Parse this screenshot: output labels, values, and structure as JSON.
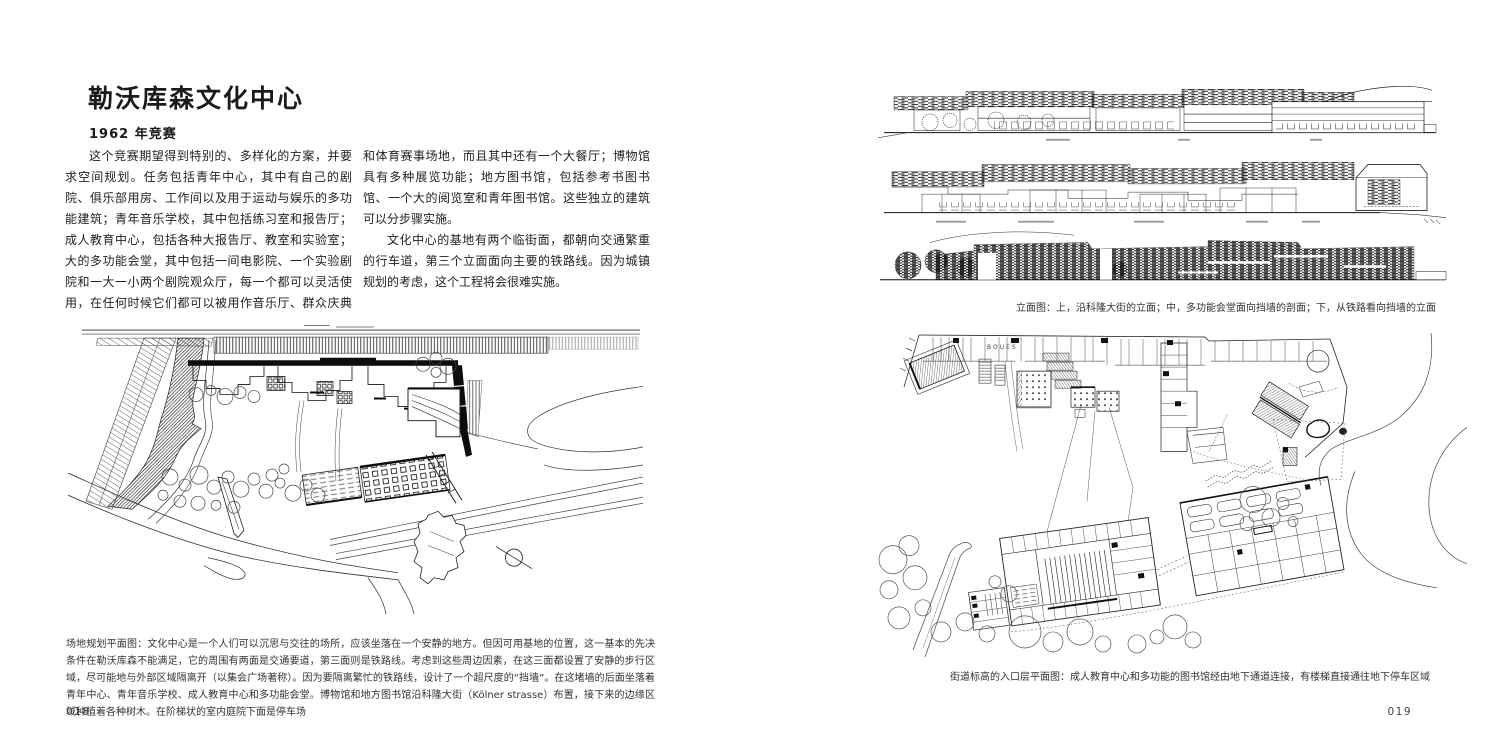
{
  "colors": {
    "paper": "#ffffff",
    "ink": "#1a1a1a",
    "caption_ink": "#333333"
  },
  "left_page": {
    "title": "勒沃库森文化中心",
    "subtitle": "1962 年竞赛",
    "body_paragraphs": [
      "这个竞赛期望得到特别的、多样化的方案，并要求空间规划。任务包括青年中心，其中有自己的剧院、俱乐部用房、工作间以及用于运动与娱乐的多功能建筑；青年音乐学校，其中包括练习室和报告厅；成人教育中心，包括各种大报告厅、教室和实验室；大的多功能会堂，其中包括一间电影院、一个实验剧院和一大一小两个剧院观众厅，每一个都可以灵活使用，在任何时候它们都可以被用作音乐厅、群众庆典和体育赛事场地，而且其中还有一个大餐厅；博物馆具有多种展览功能；地方图书馆，包括参考书图书馆、一个大的阅览室和青年图书馆。这些独立的建筑可以分步骤实施。",
      "文化中心的基地有两个临街面，都朝向交通繁重的行车道，第三个立面面向主要的铁路线。因为城镇规划的考虑，这个工程将会很难实施。"
    ],
    "site_plan_caption": "场地规划平面图：文化中心是一个人们可以沉思与交往的场所，应该坐落在一个安静的地方。但因可用基地的位置，这一基本的先决条件在勒沃库森不能满足，它的周围有两面是交通要道，第三面则是铁路线。考虑到这些周边因素，在这三面都设置了安静的步行区域，尽可能地与外部区域隔离开（以集会广场著称）。因为要隔离繁忙的铁路线，设计了一个超尺度的“挡墙”。在这堵墙的后面坐落着青年中心、青年音乐学校、成人教育中心和多功能会堂。博物馆和地方图书馆沿科隆大街（Kölner strasse）布置，接下来的边缘区域种植着各种树木。在阶梯状的室内庭院下面是停车场",
    "page_number": "018"
  },
  "right_page": {
    "elevations_caption": "立面图：上，沿科隆大街的立面；中，多功能会堂面向挡墙的剖面；下，从铁路看向挡墙的立面",
    "plan_caption": "街道标高的入口层平面图：成人教育中心和多功能的图书馆经由地下通道连接，有楼梯直接通往地下停车区域",
    "plan_room_label": "BOUES",
    "page_number": "019"
  }
}
